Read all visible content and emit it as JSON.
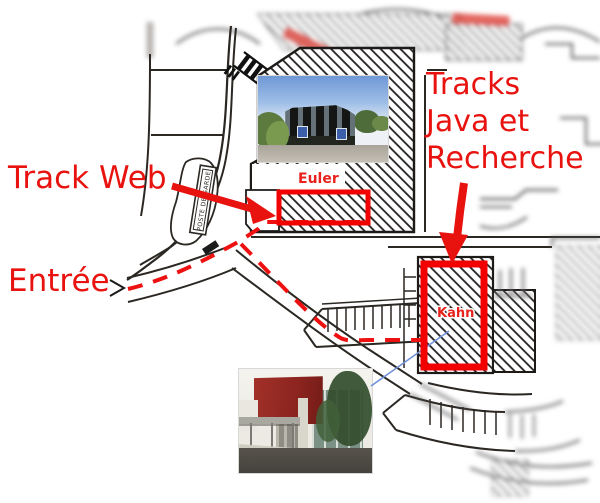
{
  "annotations": {
    "track_web": {
      "label": "Track Web"
    },
    "tracks_java_recherche": {
      "lines": [
        "Tracks",
        "Java et",
        "Recherche"
      ]
    },
    "entree": {
      "label": "Entrée"
    }
  },
  "map": {
    "labels": {
      "euler": "Euler",
      "kahn": "Kahn",
      "poste_de_garde": "POSTE DE GARDE"
    }
  },
  "colors": {
    "annotation_red": "#e8120f",
    "highlight_red": "#f20000",
    "map_line": "#2b2723",
    "connector_blue": "#7090d8"
  }
}
